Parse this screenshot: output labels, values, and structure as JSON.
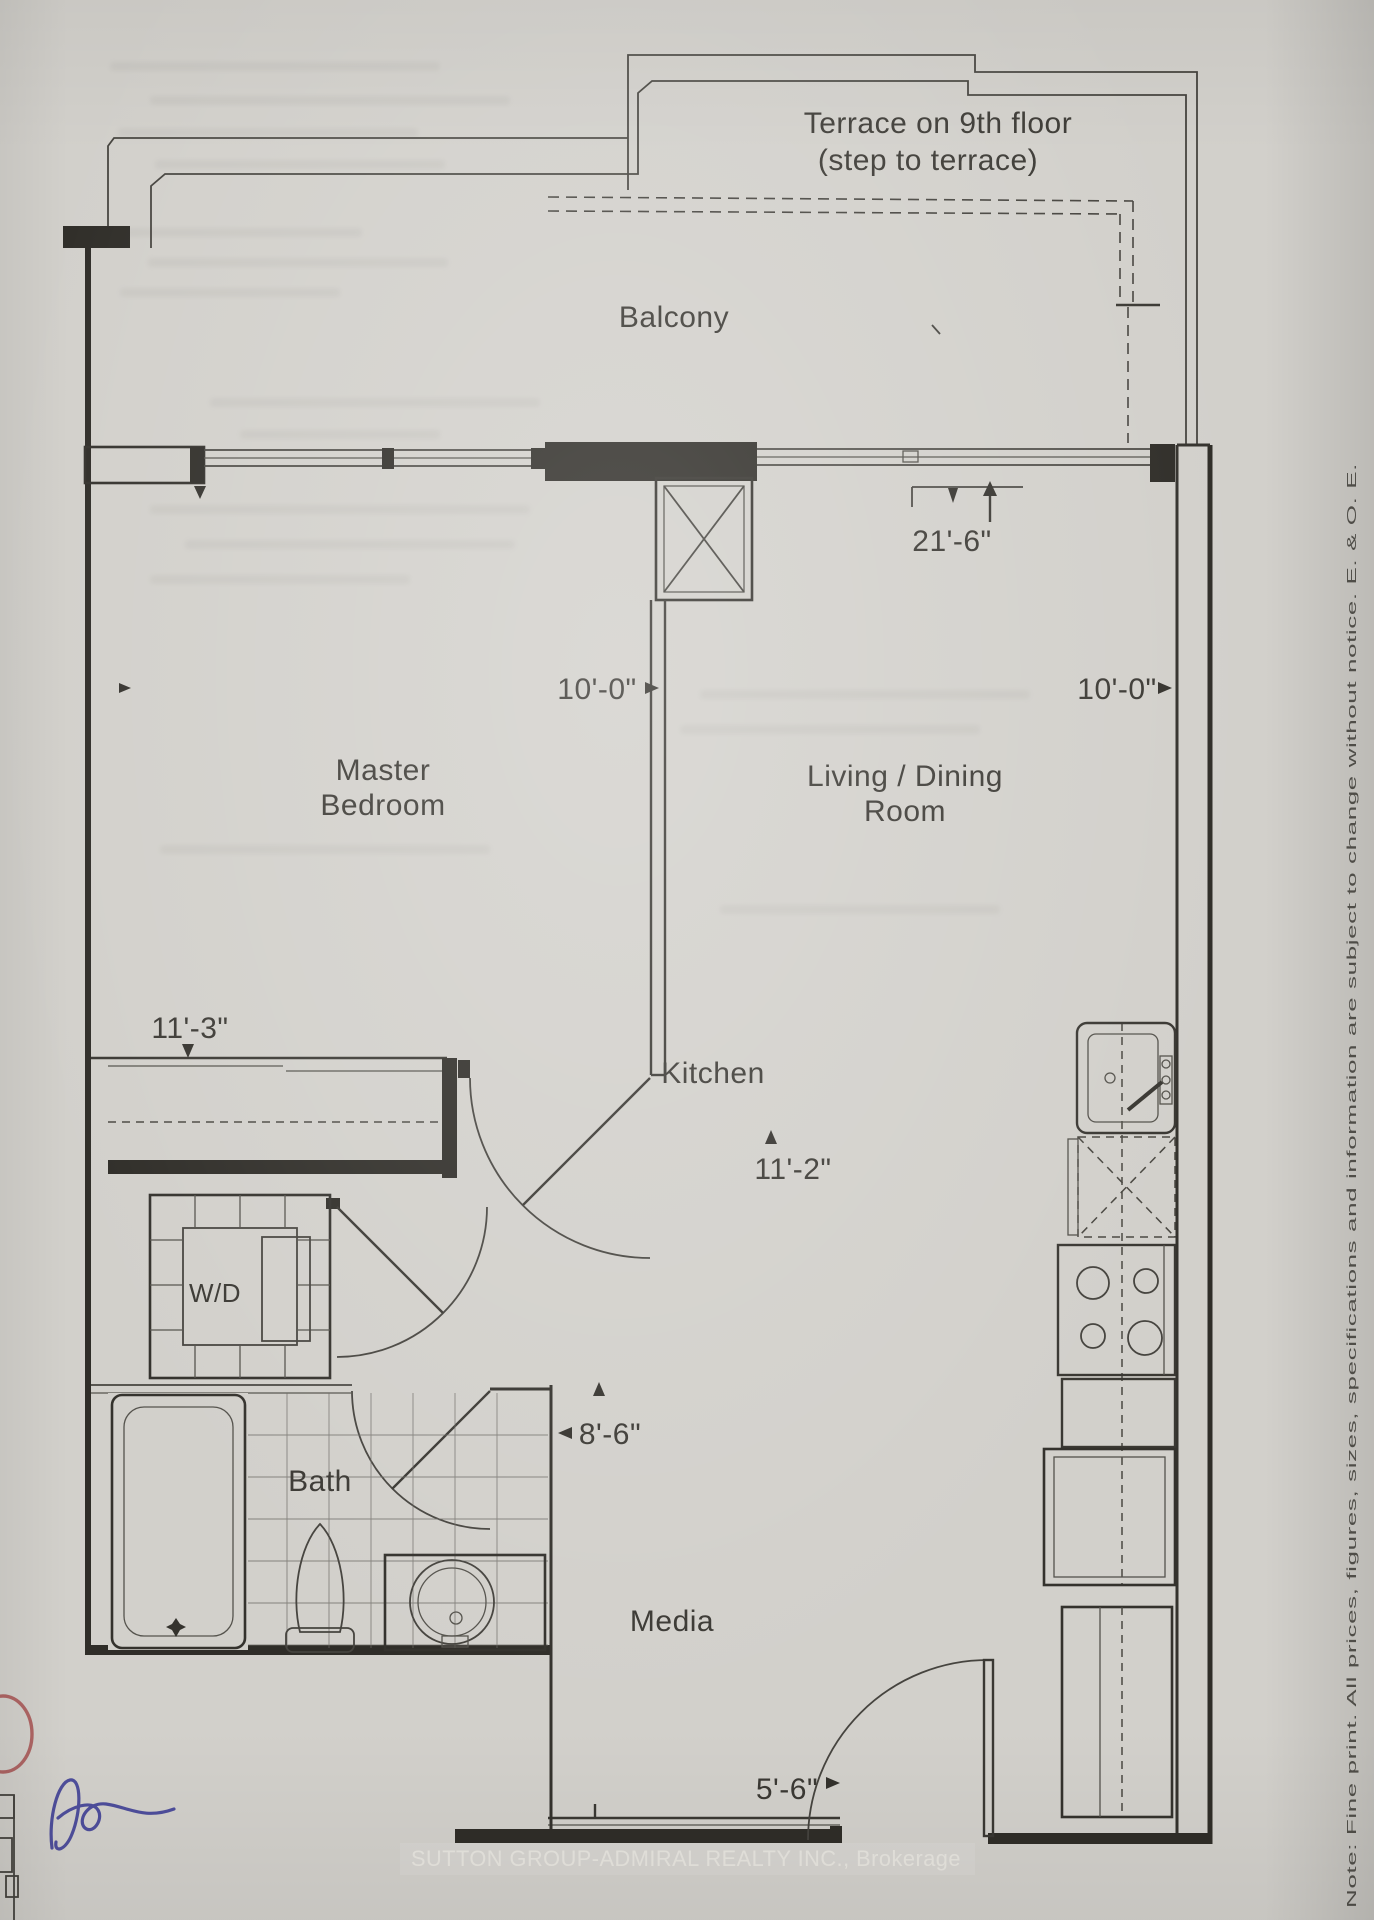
{
  "colors": {
    "paper": "#d2d0cb",
    "ink": "#34322d",
    "handwriting_blue": "#3f3f96",
    "marker_red": "#a85252"
  },
  "outdoor": {
    "terrace_line1": "Terrace on 9th floor",
    "terrace_line2": "(step to terrace)",
    "balcony": "Balcony"
  },
  "rooms": {
    "master_line1": "Master",
    "master_line2": "Bedroom",
    "living_line1": "Living / Dining",
    "living_line2": "Room",
    "kitchen": "Kitchen",
    "media": "Media",
    "bath": "Bath",
    "laundry": "W/D"
  },
  "dimensions": {
    "master_width": "10'-0\"",
    "living_width": "10'-0\"",
    "balcony_length": "21'-6\"",
    "master_length": "11'-3\"",
    "hall_width": "8'-6\"",
    "kitchen_length": "11'-2\"",
    "entry_width": "5'-6\""
  },
  "footer": {
    "brokerage_watermark": "SUTTON GROUP-ADMIRAL REALTY INC., Brokerage"
  },
  "fine_print": {
    "note": "Note: Fine print. All prices, figures, sizes, specifications and information are subject to change without notice. E. & O. E."
  },
  "annotations": {
    "handwritten_initials": "Ae"
  }
}
